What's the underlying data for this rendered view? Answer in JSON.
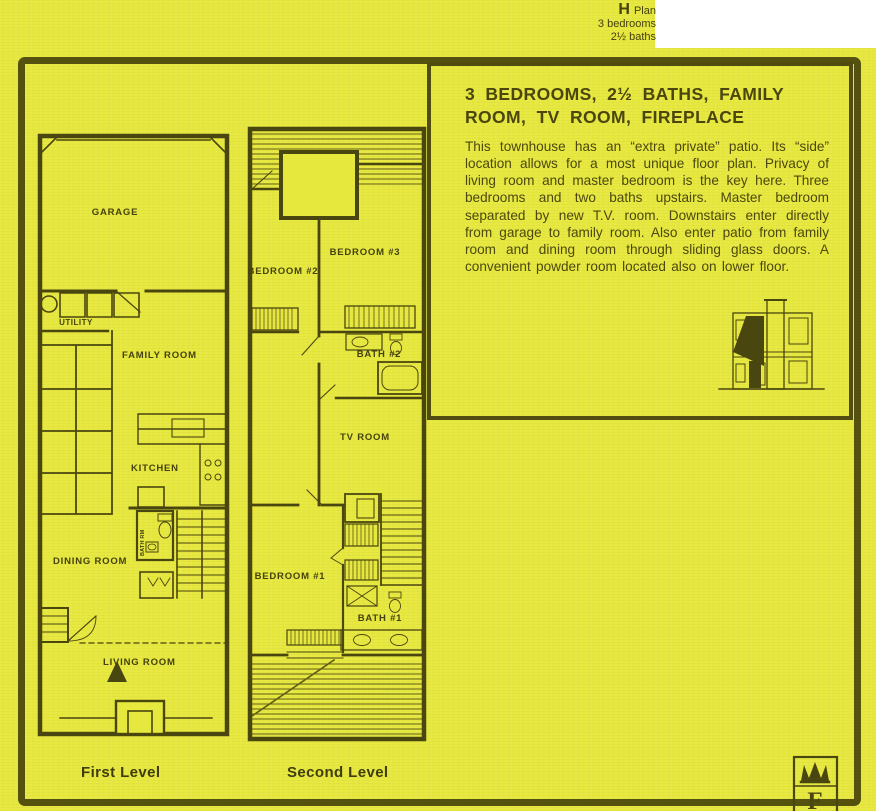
{
  "colors": {
    "paper": "#e7e83e",
    "ink": "#4a460f",
    "frame": "#55510f",
    "corner": "#ffffff"
  },
  "header": {
    "plan_letter": "H",
    "plan_word": "Plan",
    "bedrooms_line": "3 bedrooms",
    "baths_line": "2½ baths"
  },
  "info_box": {
    "title": "3 BEDROOMS, 2½ BATHS, FAMILY ROOM, TV ROOM, FIREPLACE",
    "body": "This townhouse has an “extra private” patio. Its “side” location allows for a most unique floor plan. Privacy of living room and master bedroom is the key here. Three bedrooms and two baths upstairs. Master bedroom separated by new T.V. room. Downstairs enter directly from garage to family room. Also enter patio from family room and dining room through sliding glass doors. A convenient powder room located also on lower floor."
  },
  "plans": {
    "first_level": {
      "caption": "First Level",
      "rooms": {
        "garage": "GARAGE",
        "utility": "UTILITY",
        "family_room": "FAMILY ROOM",
        "kitchen": "KITCHEN",
        "dining_room": "DINING ROOM",
        "powder_room": "BATH RM",
        "living_room": "LIVING ROOM"
      }
    },
    "second_level": {
      "caption": "Second Level",
      "rooms": {
        "bedroom_2": "BEDROOM #2",
        "bedroom_3": "BEDROOM #3",
        "bath_2": "BATH #2",
        "tv_room": "TV ROOM",
        "bedroom_1": "BEDROOM #1",
        "bath_1": "BATH #1"
      }
    }
  },
  "logo": {
    "letter": "F"
  }
}
